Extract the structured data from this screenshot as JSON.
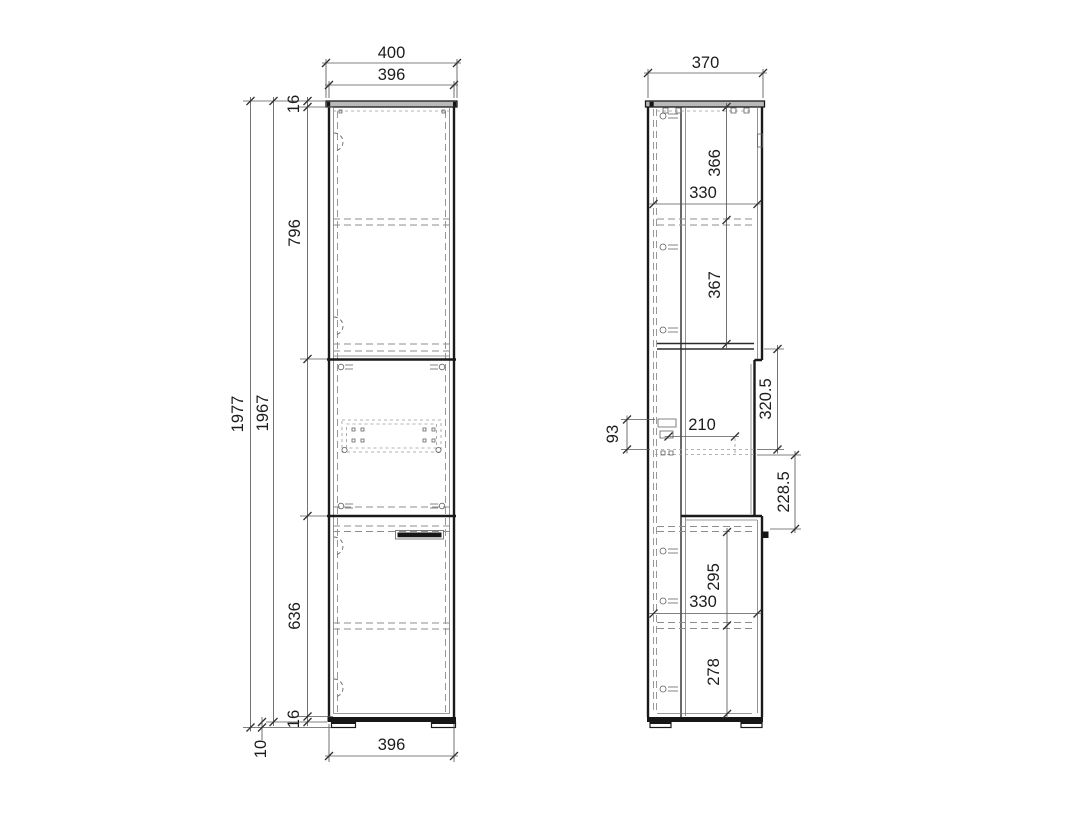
{
  "drawing": {
    "front_view": {
      "dims": {
        "overall_width": "400",
        "carcass_width": "396",
        "top_panel_thickness": "16",
        "upper_door_height": "796",
        "overall_height": "1977",
        "carcass_height": "1967",
        "lower_door_height": "636",
        "bottom_panel_thickness": "16",
        "plinth_height": "10",
        "carcass_width_bottom": "396"
      }
    },
    "side_view": {
      "dims": {
        "overall_depth": "370",
        "top_to_upper_shelf": "366",
        "upper_shelf_depth": "330",
        "upper_shelf_to_fixed_panel": "367",
        "fixed_panel_to_runner": "320.5",
        "runner_length": "210",
        "runner_bracket_height": "93",
        "runner_to_handle": "228.5",
        "handle_to_lower_shelf": "295",
        "lower_shelf_depth": "330",
        "lower_shelf_to_bottom": "278"
      }
    }
  }
}
